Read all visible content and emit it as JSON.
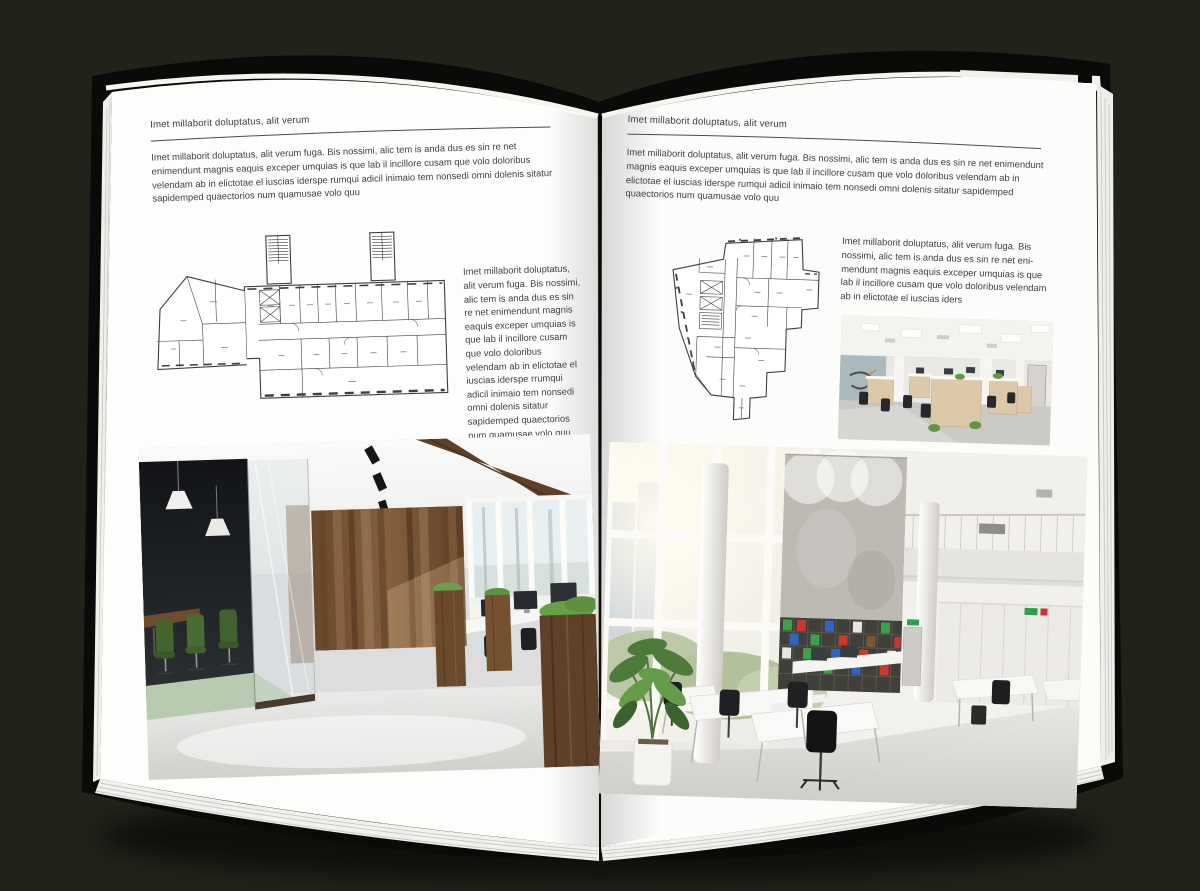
{
  "palette": {
    "background": "#21221a",
    "book_cover": "#0a0a08",
    "paper": "#fdfdfc",
    "text": "#3f3f3f",
    "header_rule": "#4b4b4b",
    "floorplan_ink": "#3e3e3e",
    "wood_brown": "#7a563a",
    "chair_green": "#44632f",
    "plant_green": "#4e7a3a",
    "binder_red": "#c8392c",
    "binder_green": "#3da04a",
    "binder_blue": "#2f66c4"
  },
  "left_page": {
    "header": "Imet millaborit doluptatus, alit verum",
    "intro_paragraph": "Imet millaborit doluptatus, alit verum fuga. Bis nossimi, alic tem is anda dus es sin re net enimendunt magnis eaquis exceper umquias is que lab il incillore cusam que volo doloribus velendam ab in elictotae el iuscias iderspe rumqui adicil inimaio tem nonsedi omni dolenis sitatur sapidemped quaectorios num quamusae volo quu",
    "side_paragraph": "Imet millaborit doluptatus, alit verum fuga. Bis nossimi, alic tem is anda dus es sin re net enimendunt magnis eaquis exceper umquias is que lab il incillore cusam que volo doloribus velendam ab in elictotae el iuscias iderspe rrumqui adicil inimaio tem nonsedi omni dolenis sitatur sapidemped quaectorios num quamusae volo quu"
  },
  "right_page": {
    "header": "Imet millaborit doluptatus, alit verum",
    "intro_paragraph": "Imet millaborit doluptatus, alit verum fuga. Bis nossimi, alic tem is anda dus es sin re net enimendunt magnis eaquis exceper umquias is que lab il incillore cusam que volo doloribus velendam ab in elictotae el iuscias iderspe rumqui adicil inimaio tem nonsedi omni dolenis sitatur sapidemped quaectorios num quamusae volo quu",
    "side_paragraph": "Imet millaborit doluptatus, alit verum fuga. Bis nossimi, alic tem is anda dus es sin re net eni-mendunt magnis eaquis exceper umquias is que lab il incillore cusam que volo doloribus velendam ab in elictotae el iuscias iders"
  },
  "images": {
    "left_floorplan": "architectural-floorplan-rectangular-building",
    "left_photo_large": "office-interior-photo-wood-and-glass-meeting-room",
    "right_floorplan": "architectural-floorplan-irregular-building",
    "right_photo_small": "office-interior-photo-open-plan-workstations",
    "right_photo_large": "office-interior-photo-white-atrium"
  }
}
